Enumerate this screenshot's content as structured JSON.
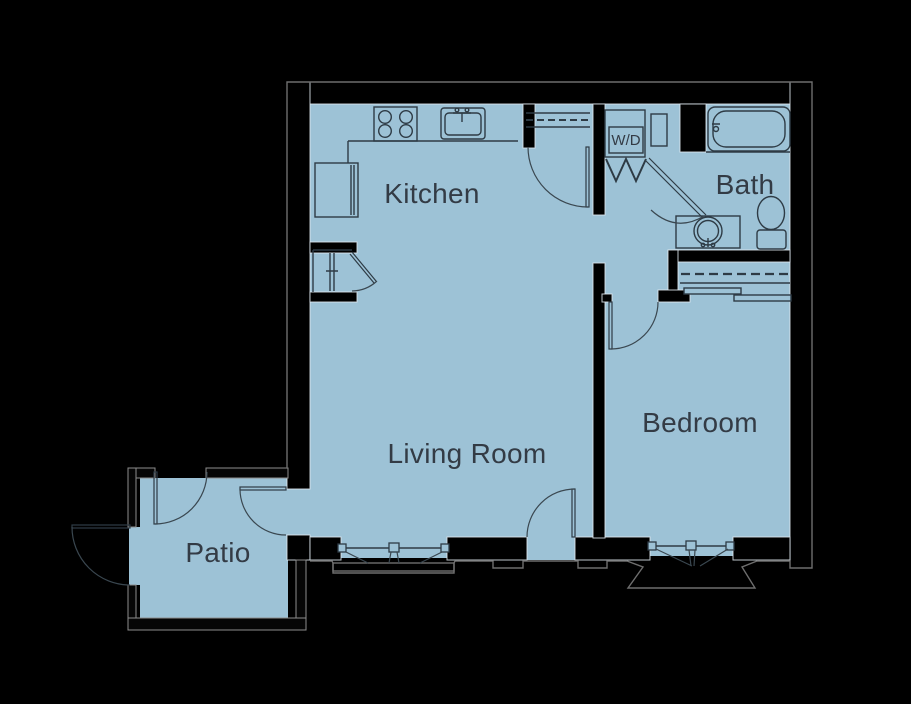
{
  "page": {
    "background": "#000000",
    "type": "apartment-floor-plan"
  },
  "floor_plan": {
    "colors": {
      "floor": "#9dc2d6",
      "wall": "#000000",
      "fixture_line": "#2e3b45",
      "outer_outline": "#6e6e6e",
      "label_text": "#333b45"
    },
    "rooms": {
      "kitchen": {
        "label": "Kitchen"
      },
      "living_room": {
        "label": "Living Room"
      },
      "bedroom": {
        "label": "Bedroom"
      },
      "bath": {
        "label": "Bath"
      },
      "patio": {
        "label": "Patio"
      },
      "laundry": {
        "label": "W/D"
      }
    },
    "fixtures": [
      "range-cooktop",
      "kitchen-sink",
      "refrigerator",
      "pantry-closet",
      "washer-dryer-closet",
      "bifold-doors",
      "bathtub",
      "bathroom-vanity-sink",
      "toilet",
      "linen-cabinet",
      "closet-rod",
      "sliding-closet-doors",
      "bay-window-living-room",
      "bay-window-bedroom",
      "entry-door",
      "bedroom-door",
      "bath-door",
      "patio-doors",
      "patio-gate"
    ]
  }
}
